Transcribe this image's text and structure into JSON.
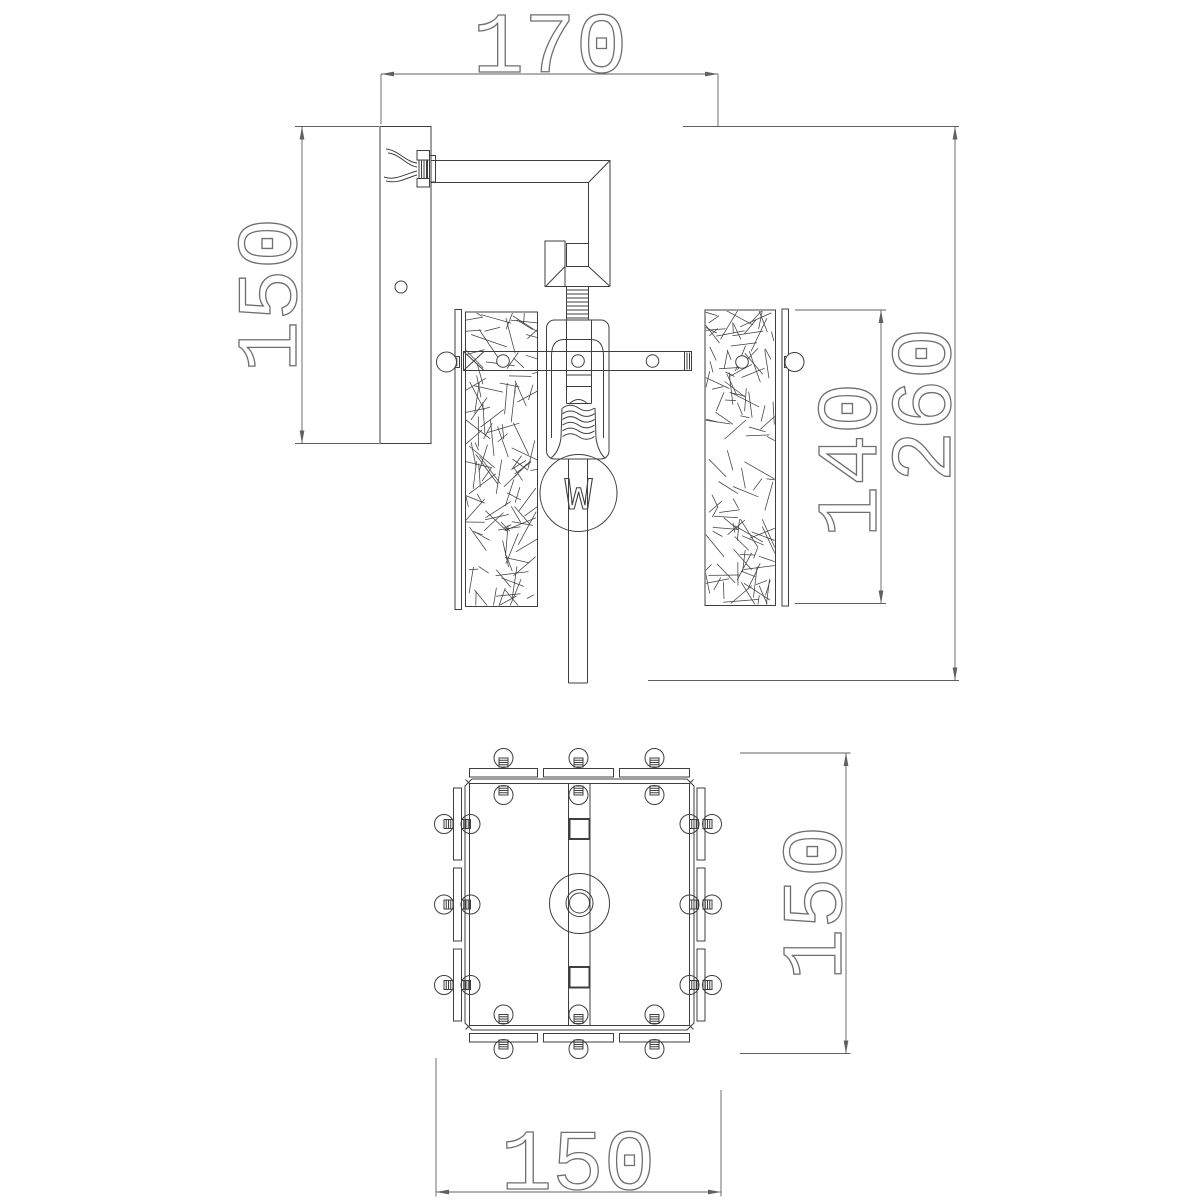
{
  "drawing": {
    "background": "#ffffff",
    "line_color": "#3f3f3f",
    "dimension_color": "#606060",
    "dimension_text_color": "#6f6f6f",
    "bulb_symbol": "W",
    "views": {
      "side_view": {
        "dimensions": [
          {
            "id": "bracket-depth",
            "value": "170"
          },
          {
            "id": "backplate-height",
            "value": "150"
          },
          {
            "id": "shade-height",
            "value": "140"
          },
          {
            "id": "overall-height",
            "value": "260"
          }
        ]
      },
      "bottom_view": {
        "dimensions": [
          {
            "id": "base-depth",
            "value": "150"
          },
          {
            "id": "base-width",
            "value": "150"
          }
        ]
      }
    }
  }
}
